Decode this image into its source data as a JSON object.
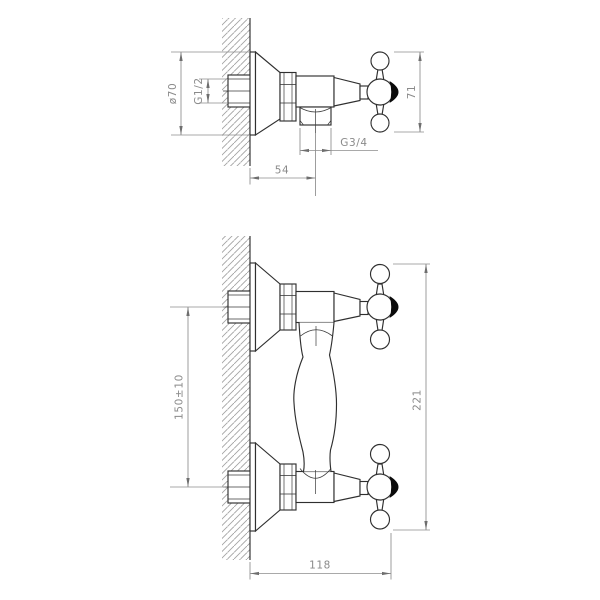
{
  "drawing": {
    "dimensions_side_view": {
      "escutcheon_diameter": "ø70",
      "inlet_thread": "G1/2",
      "handle_height": "71",
      "outlet_thread": "G3/4",
      "wall_to_outlet": "54"
    },
    "dimensions_front_view": {
      "inlet_spacing": "150±10",
      "overall_height": "221",
      "overall_width": "118"
    },
    "colors": {
      "outline": "#2f2f2f",
      "dimension_gray": "#8c8c8c",
      "hatch_gray": "#a3a3a3",
      "handle_cap": "#0a0a0a",
      "background": "#ffffff"
    }
  }
}
